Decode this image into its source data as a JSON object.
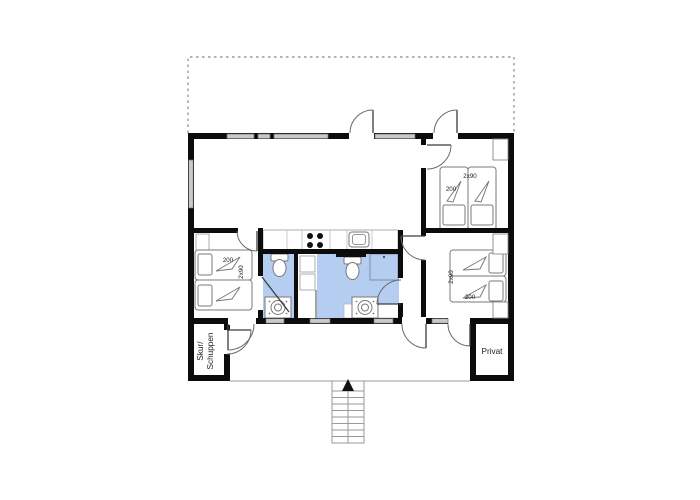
{
  "floorplan": {
    "labels": {
      "shed_line1": "Skur/",
      "shed_line2": "Schuppen",
      "private": "Privat"
    },
    "bedrooms": {
      "left": {
        "bed_length": "200",
        "bed_size": "2x90"
      },
      "top_right": {
        "bed_length": "200",
        "bed_size": "2x90"
      },
      "right": {
        "bed_length": "200",
        "bed_size": "2x90"
      }
    },
    "colors": {
      "wall": "#0c0c0c",
      "wet_room_fill": "#b5cdf0",
      "window_fill": "#c9c9c9",
      "terrace_dash": "#9a9a9a"
    }
  }
}
